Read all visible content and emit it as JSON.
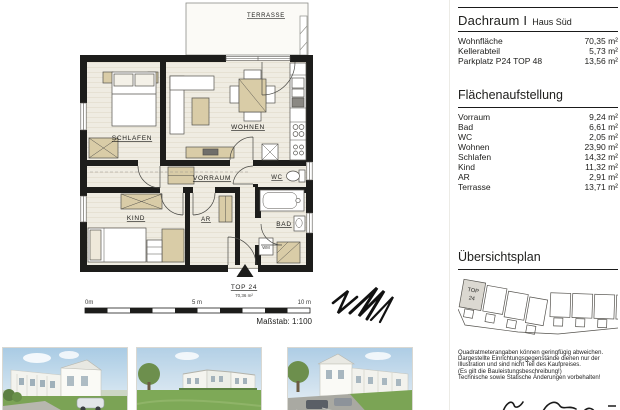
{
  "plan": {
    "terrace_label": "TERRASSE",
    "rooms": {
      "schlafen": "SCHLAFEN",
      "wohnen": "WOHNEN",
      "vorraum": "VORRAUM",
      "wc": "WC",
      "kind": "KIND",
      "ar": "AR",
      "bad": "BAD"
    },
    "wm_label": "WM",
    "unit": {
      "name": "TOP 24",
      "area": "70,36 m²"
    },
    "scale": {
      "zero": "0m",
      "five": "5 m",
      "ten": "10 m",
      "caption": "Maßstab: 1:100"
    }
  },
  "panel": {
    "title": "Dachraum I",
    "subtitle": "Haus Süd",
    "summary": [
      {
        "label": "Wohnfläche",
        "value": "70,35 m²"
      },
      {
        "label": "Kellerabteil",
        "value": "5,73 m²"
      },
      {
        "label": "Parkplatz P24 TOP 48",
        "value": "13,56 m²"
      }
    ],
    "areas_heading": "Flächenaufstellung",
    "areas": [
      {
        "label": "Vorraum",
        "value": "9,24 m²"
      },
      {
        "label": "Bad",
        "value": "6,61 m²"
      },
      {
        "label": "WC",
        "value": "2,05 m²"
      },
      {
        "label": "Wohnen",
        "value": "23,90 m²"
      },
      {
        "label": "Schlafen",
        "value": "14,32 m²"
      },
      {
        "label": "Kind",
        "value": "11,32 m²"
      },
      {
        "label": "AR",
        "value": "2,91 m²"
      },
      {
        "label": "Terrasse",
        "value": "13,71 m²"
      }
    ],
    "overview_heading": "Übersichtsplan",
    "overview_unit_line1": "TOP",
    "overview_unit_line2": "24",
    "disclaimer": [
      "Quadratmeterangaben können geringfügig abweichen.",
      "Dargestellte Einrichtungsgegenstände dienen nur der",
      "Illustration und sind nicht Teil des Kaufpreises.",
      "(Es gilt die Bauleistungsbeschreibung!)",
      "Technische sowie Statische Änderungen vorbehalten!"
    ]
  },
  "colors": {
    "wall": "#1d1d1b",
    "floor": "#efece2",
    "furniture_beige": "#d9cca7",
    "accent_green": "#76b043"
  }
}
